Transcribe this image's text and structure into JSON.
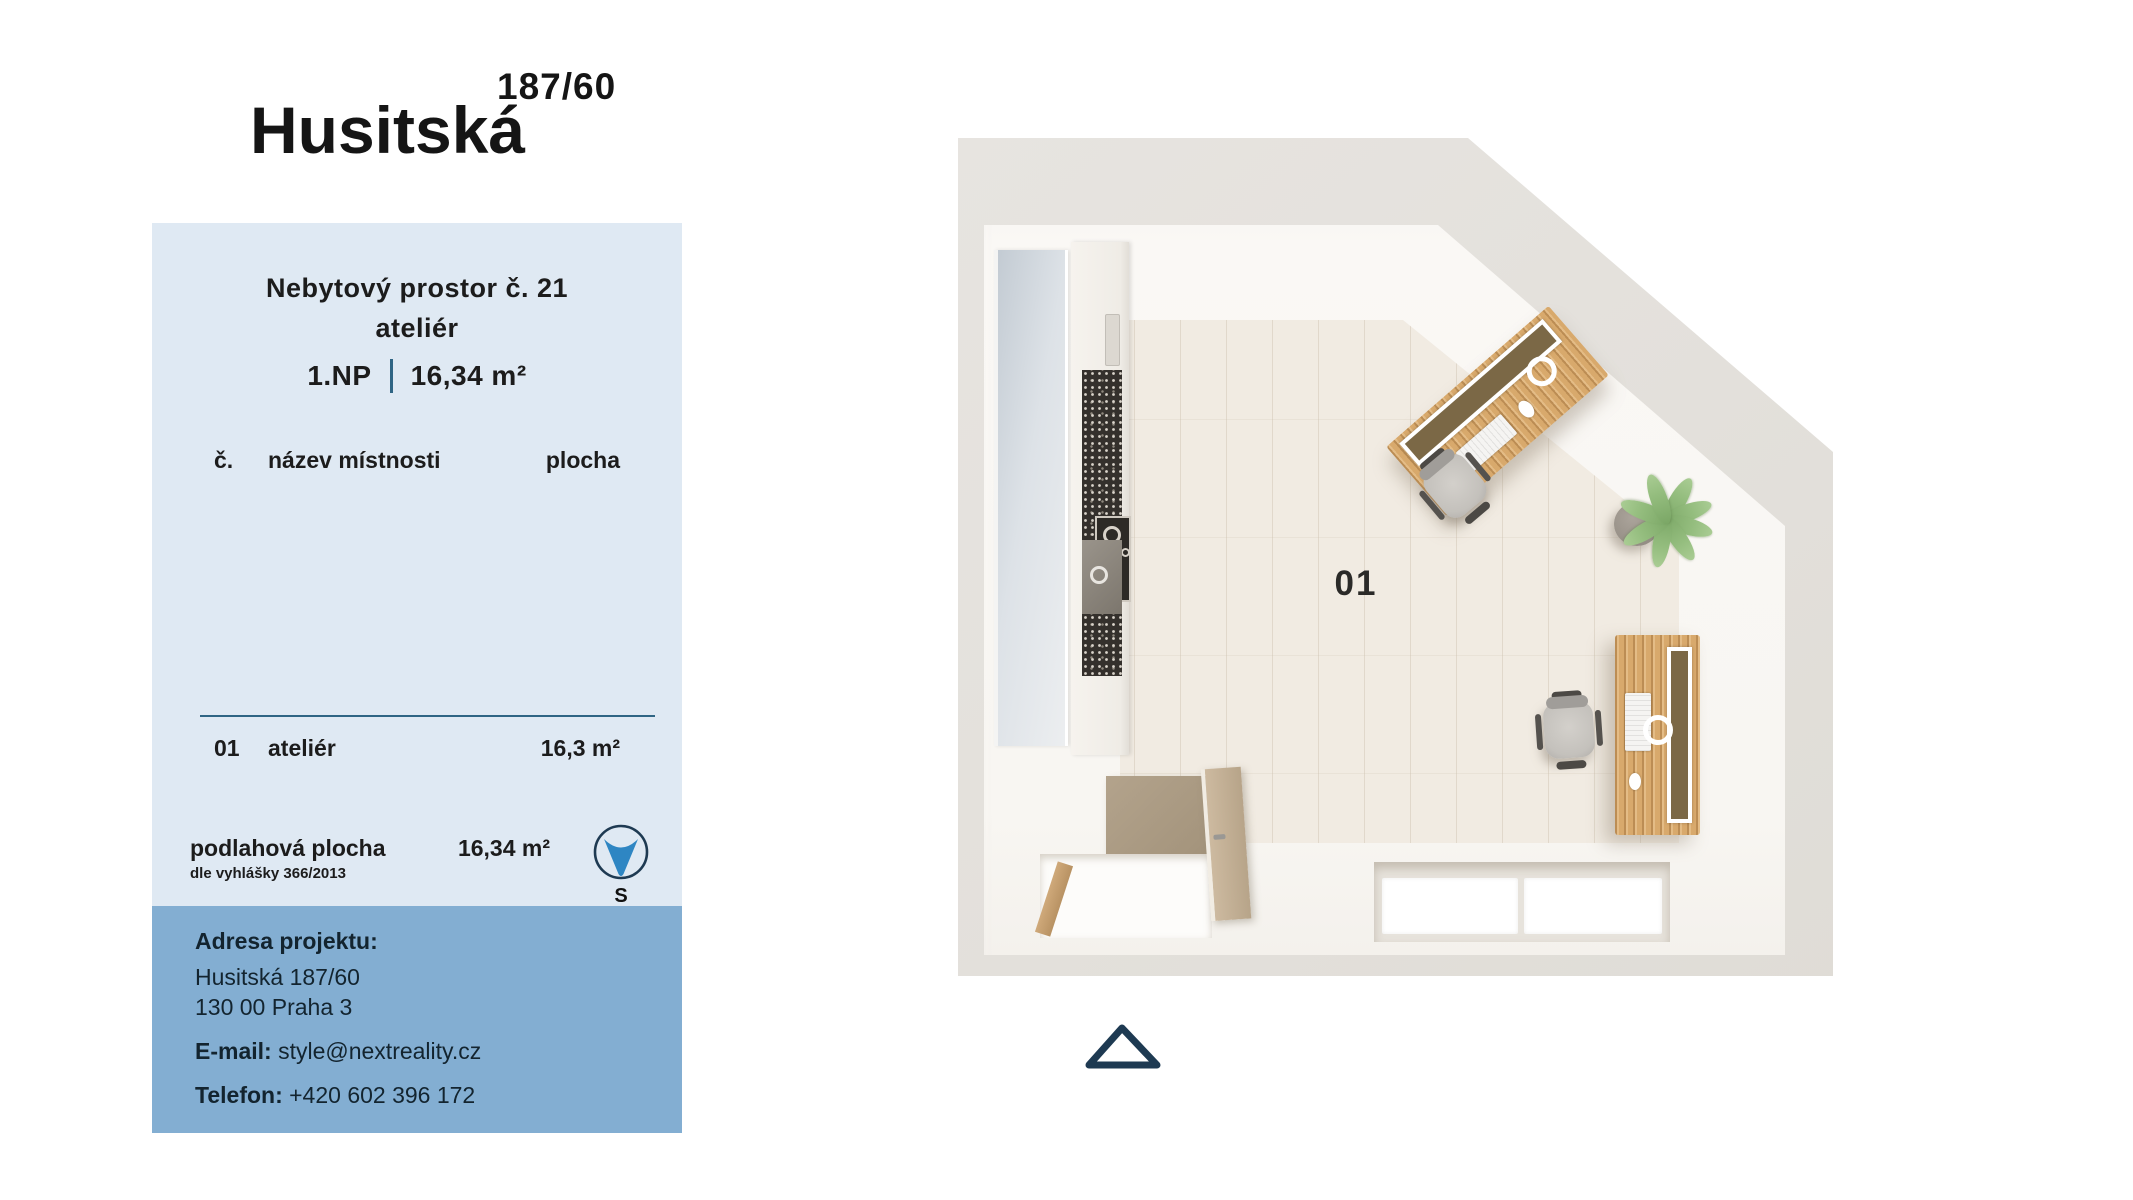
{
  "header": {
    "street": "Husitská",
    "number": "187/60"
  },
  "panel": {
    "title_line1": "Nebytový prostor č. 21",
    "title_line2": "ateliér",
    "floor": "1.NP",
    "separator": "|",
    "area": "16,34 m²",
    "table": {
      "headers": [
        "č.",
        "název místnosti",
        "plocha"
      ],
      "rows": [
        {
          "num": "01",
          "name": "ateliér",
          "area": "16,3 m²"
        }
      ]
    },
    "summary": {
      "label": "podlahová plocha",
      "note": "dle vyhlášky 366/2013",
      "value": "16,34 m²"
    },
    "compass": {
      "letter": "S"
    },
    "address": {
      "heading": "Adresa projektu:",
      "line1": "Husitská 187/60",
      "line2": "130 00 Praha 3",
      "email_label": "E-mail:",
      "email": "style@nextreality.cz",
      "phone_label": "Telefon:",
      "phone": "+420 602 396 172"
    }
  },
  "plan": {
    "room_label": "01"
  },
  "colors": {
    "panel_light": "#dfe9f3",
    "panel_dark": "#83aed2",
    "rule_blue": "#2f6584",
    "compass_blue": "#2e86c3",
    "navy_outline": "#1e3a52",
    "wall_gray": "#e3e0db",
    "floor_tile": "#f1ebe2",
    "desk_wood": "#d8a96c"
  }
}
